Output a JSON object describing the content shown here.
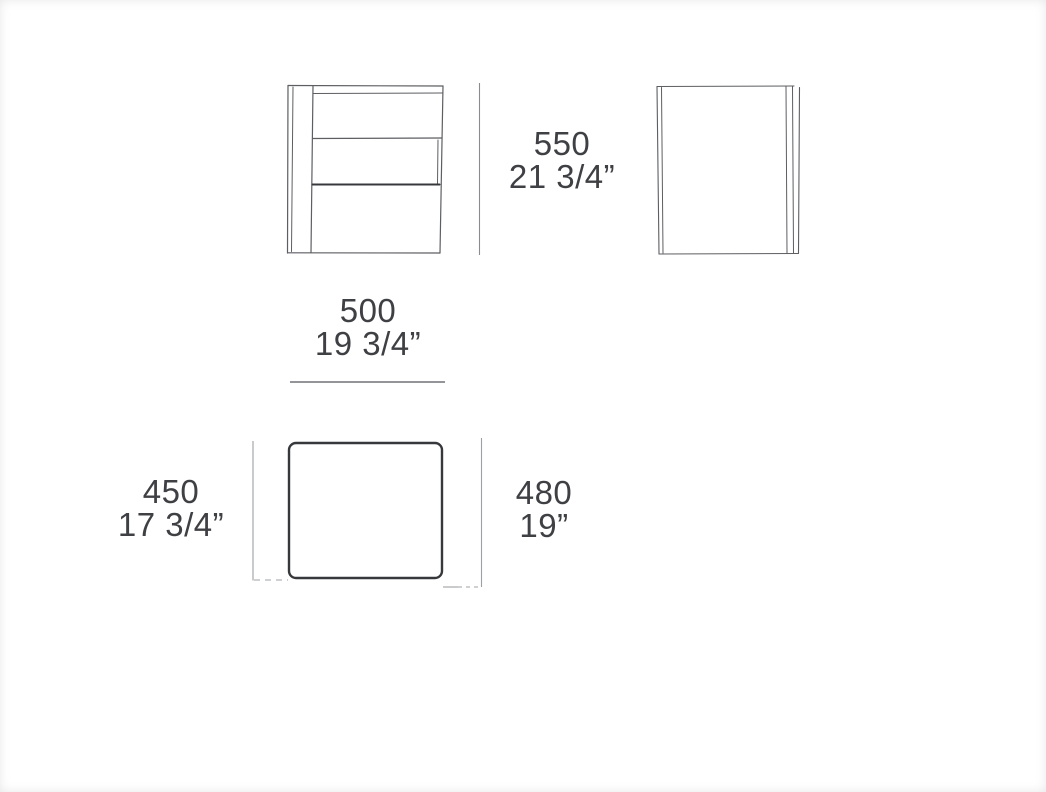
{
  "drawing": {
    "type": "furniture-dimension-diagram",
    "views": [
      "front-view",
      "side-view",
      "plan-view"
    ],
    "colors": {
      "background": "#ffffff",
      "sketch_line": "#5d5e62",
      "dark_line": "#37383c",
      "dimension_line": "#9fa0a3",
      "text": "#3f4044"
    }
  },
  "dimensions": {
    "height": {
      "mm": "550",
      "inches": "21 3/4”"
    },
    "width": {
      "mm": "500",
      "inches": "19 3/4”"
    },
    "depth": {
      "mm": "450",
      "inches": "17 3/4”"
    },
    "overall_depth": {
      "mm": "480",
      "inches": "19”"
    }
  }
}
